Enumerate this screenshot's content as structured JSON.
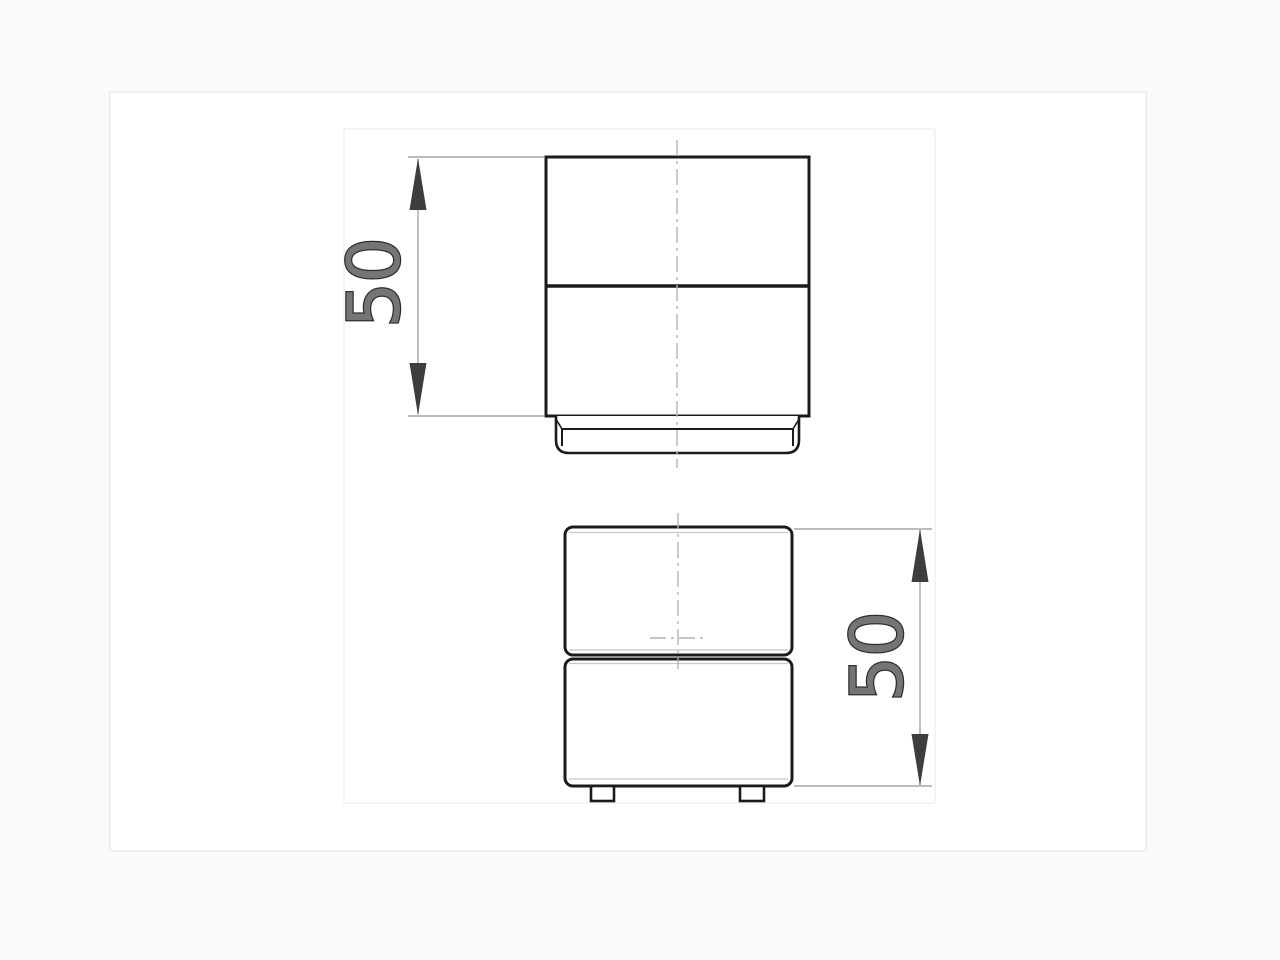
{
  "drawing": {
    "views": [
      {
        "id": "side-view",
        "dimension": {
          "value": "50"
        }
      },
      {
        "id": "front-view",
        "dimension": {
          "value": "50"
        }
      }
    ],
    "colors": {
      "background": "#fafafa",
      "sheet": "#ffffff",
      "sheet_border": "#e2e2e2",
      "frame_border": "#ededed",
      "outline": "#1b1b1b",
      "centerline": "#b3b3b3",
      "tangent_edge": "#c8c8c8",
      "dimension_line": "#a6a6a6",
      "arrowhead": "#3d3d3d",
      "label_fill": "#757575",
      "label_outline": "#2e2e2e"
    }
  }
}
